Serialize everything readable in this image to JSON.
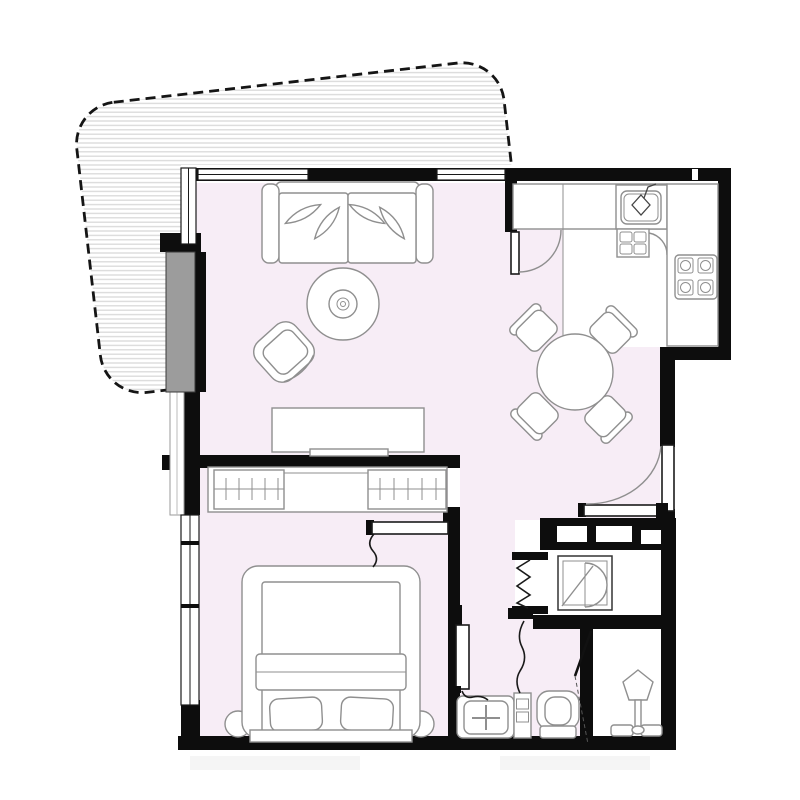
{
  "document": {
    "kind": "apartment floor plan drawing",
    "canvas_px": 800
  },
  "colors": {
    "floor": "#f7edf6",
    "kitchen_floor": "#ffffff",
    "wall": "#0d0d0d",
    "furniture_line": "#8f8f8f",
    "door_line": "#1a1a1a",
    "hatch_line": "#dcdcdc",
    "panel": "#9c9c9c",
    "background": "#ffffff"
  },
  "rooms": [
    {
      "id": "terrace",
      "label": "terrace (hatched deck, dashed boundary)"
    },
    {
      "id": "living-room",
      "label": "living room"
    },
    {
      "id": "dining-area",
      "label": "dining area"
    },
    {
      "id": "kitchen",
      "label": "kitchen"
    },
    {
      "id": "hallway",
      "label": "entrance hall"
    },
    {
      "id": "bedroom",
      "label": "bedroom"
    },
    {
      "id": "bathroom",
      "label": "bathroom"
    },
    {
      "id": "wc",
      "label": "toilet room"
    },
    {
      "id": "laundry-closet",
      "label": "laundry closet"
    }
  ],
  "furniture": {
    "living_room": [
      "sofa with pillows",
      "round rug",
      "side table",
      "armchair",
      "tv console"
    ],
    "dining_area": [
      "round dining table",
      "dining chair x4"
    ],
    "kitchen": [
      "counter",
      "sink with faucet",
      "dishwasher",
      "corner cabinet door",
      "stove 4 burners"
    ],
    "bedroom": [
      "wardrobe with hanging rails",
      "double bed",
      "pillow x2",
      "nightstand x2",
      "headboard"
    ],
    "bathroom": [
      "washbasin vanity",
      "drawer cabinet",
      "toilet"
    ],
    "laundry_closet": [
      "washing machine"
    ],
    "wc": [
      "floor fixture"
    ]
  },
  "doors": [
    "entrance-door (swing arc)",
    "living-dining-door (swing arc)",
    "bedroom-door (leaf with swing squiggle)",
    "bathroom-door (leaf with swing squiggle)",
    "laundry-folding-door (zigzag)",
    "wc-door (angled leaf)"
  ],
  "windows": [
    "top-wall window left",
    "top-wall window center",
    "left-wall living window",
    "left-wall glazing strip",
    "left-wall bedroom window",
    "sliding panel (gray)"
  ],
  "structure": [
    "duct shaft band with vents",
    "exterior walls",
    "interior partitions"
  ]
}
